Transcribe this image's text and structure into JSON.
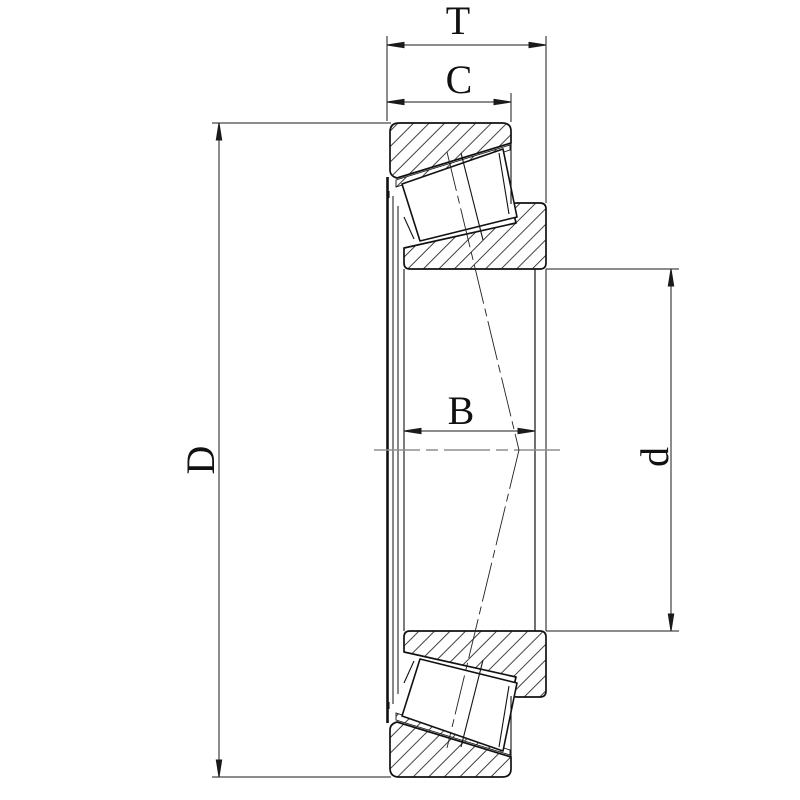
{
  "drawing": {
    "labels": {
      "total_width": "T",
      "cup_width": "C",
      "cone_width": "B",
      "outer_diameter": "D",
      "bore_diameter": "d"
    },
    "colors": {
      "line": "#1a1a1a",
      "hatch": "#2a2a2a",
      "centerline": "#8f8f8f",
      "background": "#ffffff"
    }
  }
}
